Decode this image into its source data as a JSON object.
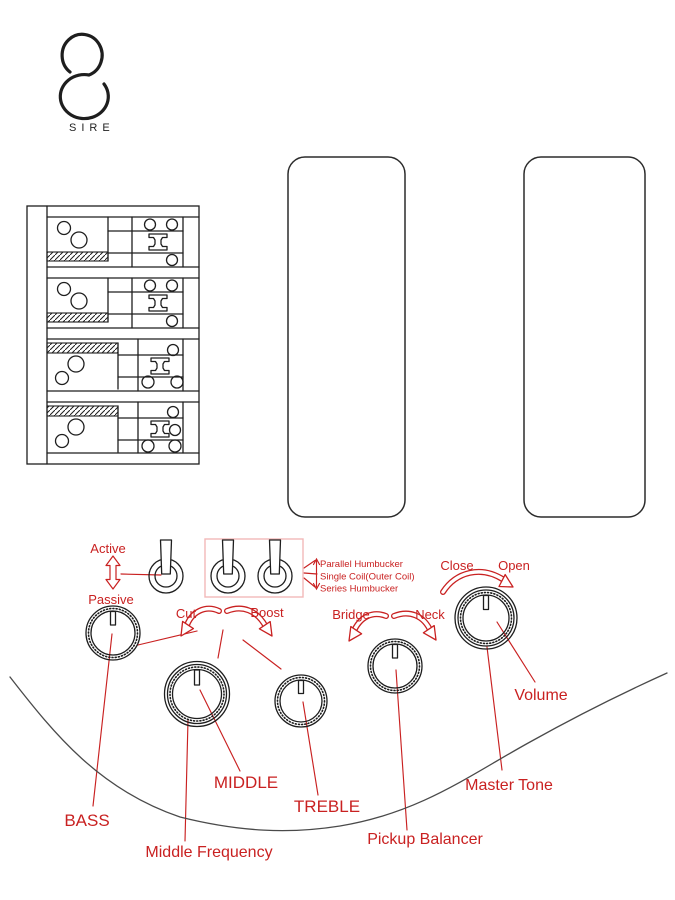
{
  "brand": {
    "logo_text": "SIRE"
  },
  "colors": {
    "accent": "#c92121",
    "accent_light": "#f3b8b8",
    "ink": "#1e1e1e",
    "curve": "#4a4a4a"
  },
  "controls": {
    "active_label": "Active",
    "passive_label": "Passive",
    "mode_switch_labels": [
      "Parallel Humbucker",
      "Single Coil(Outer Coil)",
      "Series Humbucker"
    ],
    "cut_label": "Cut",
    "boost_label": "Boost",
    "bridge_label": "Bridge",
    "neck_label": "Neck",
    "close_label": "Close",
    "open_label": "Open",
    "bass_label": "BASS",
    "middle_label": "MIDDLE",
    "treble_label": "TREBLE",
    "middle_frequency_label": "Middle Frequency",
    "pickup_balancer_label": "Pickup Balancer",
    "master_tone_label": "Master Tone",
    "volume_label": "Volume"
  }
}
